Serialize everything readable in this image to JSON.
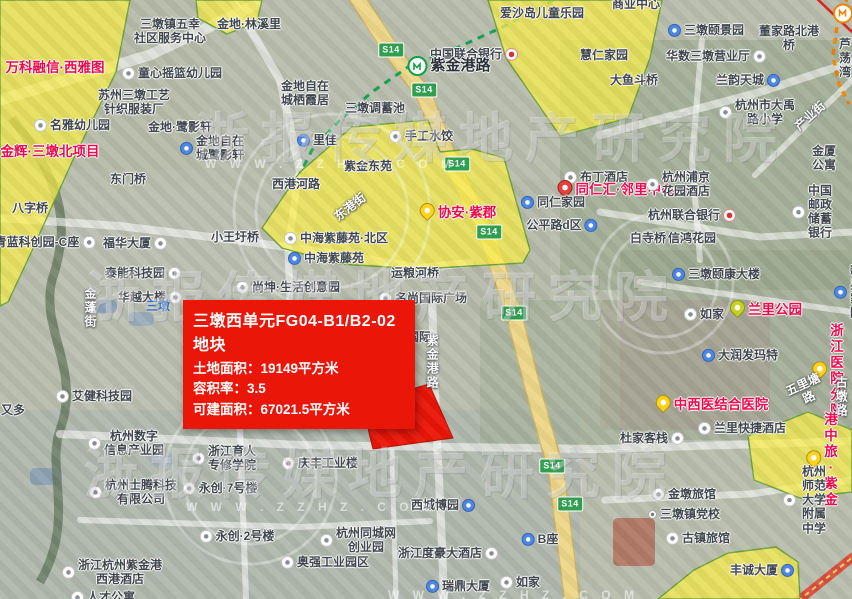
{
  "map": {
    "colors": {
      "parcel_yellow": "#faee46",
      "parcel_border": "#6fa23a",
      "parcel_red": "#ea1608",
      "metro_green": "#18a558",
      "metro_orange": "#f08300",
      "expressway_yellow": "#edd78a"
    },
    "callout": {
      "title": "三墩西单元FG04-B1/B2-02地块",
      "lines": [
        "土地面积：19149平方米",
        "容积率：3.5",
        "可建面积：67021.5平方米"
      ]
    },
    "watermark": {
      "brand": "浙报传媒地产研究院",
      "site": "W W W . Z Z H Z . C O M",
      "big_rows": [
        {
          "x": 195,
          "y": 94
        },
        {
          "x": 86,
          "y": 253
        },
        {
          "x": 84,
          "y": 430
        }
      ],
      "small_rows": [
        {
          "x": 205,
          "y": 157
        },
        {
          "x": 186,
          "y": 500
        },
        {
          "x": 388,
          "y": 588
        }
      ]
    },
    "s14": {
      "label": "S14",
      "positions": [
        [
          391,
          50
        ],
        [
          424,
          90
        ],
        [
          457,
          164
        ],
        [
          489,
          232
        ],
        [
          514,
          313
        ],
        [
          552,
          466
        ],
        [
          570,
          504
        ]
      ]
    },
    "parcels": {
      "yellow": [
        {
          "pts": "0,0 130,0 116,72 72,162 30,255 8,302 0,306"
        },
        {
          "pts": "196,0 262,0 257,22 227,34 198,18"
        },
        {
          "pts": "488,0 662,0 650,58 628,118 560,136 506,58"
        },
        {
          "pts": "300,172 352,127 428,120 440,152 472,149 504,158 530,250 523,263 420,269 340,264 282,248 262,228"
        },
        {
          "pts": "748,436 808,412 852,430 852,492 800,498 754,480"
        },
        {
          "pts": "658,599 694,570 728,553 776,547 798,562 800,599"
        }
      ],
      "red": {
        "pts": "362,404 429,384 453,438 373,449"
      },
      "tail": {
        "pts": "328,394 437,412 388,394"
      }
    },
    "labels": [
      {
        "t": "三墩镇五幸\n社区服务中心",
        "x": 170,
        "y": 31,
        "c": "poi"
      },
      {
        "t": "金地·林溪里",
        "x": 249,
        "y": 24,
        "c": "poi"
      },
      {
        "t": "童心摇篮幼儿园",
        "x": 172,
        "y": 73,
        "c": "poi",
        "ic": "w"
      },
      {
        "t": "苏州三墩工艺\n针织服装厂",
        "x": 134,
        "y": 102,
        "c": "poi"
      },
      {
        "t": "名雅幼儿园",
        "x": 72,
        "y": 125,
        "c": "poi",
        "ic": "w"
      },
      {
        "t": "金地·鹭影轩",
        "x": 180,
        "y": 127,
        "c": "poi"
      },
      {
        "t": "金地自在\n城鹭影轩",
        "x": 212,
        "y": 148,
        "c": "poi",
        "ic": "b"
      },
      {
        "t": "万科融信·西雅图",
        "x": 55,
        "y": 68,
        "c": "red"
      },
      {
        "t": "金辉·三墩北项目",
        "x": 50,
        "y": 152,
        "c": "red"
      },
      {
        "t": "东门桥",
        "x": 128,
        "y": 179,
        "c": "poi"
      },
      {
        "t": "西港河路",
        "x": 296,
        "y": 184,
        "c": "poi"
      },
      {
        "t": "八字桥",
        "x": 30,
        "y": 208,
        "c": "poi"
      },
      {
        "t": "青蓝科创园-C座",
        "x": 45,
        "y": 242,
        "c": "poi",
        "ic": "w",
        "s": "r"
      },
      {
        "t": "福华大厦",
        "x": 135,
        "y": 243,
        "c": "poi",
        "ic": "w",
        "s": "r"
      },
      {
        "t": "小王圩桥",
        "x": 235,
        "y": 237,
        "c": "poi"
      },
      {
        "t": "泰能科技园",
        "x": 143,
        "y": 273,
        "c": "poi",
        "ic": "w",
        "s": "r"
      },
      {
        "t": "华越大楼",
        "x": 150,
        "y": 297,
        "c": "poi",
        "ic": "w",
        "s": "r"
      },
      {
        "t": "三墩",
        "x": 158,
        "y": 306,
        "c": "blue"
      },
      {
        "t": "尚坤·生活创意园",
        "x": 288,
        "y": 287,
        "c": "poi",
        "ic": "w"
      },
      {
        "t": "金蓬街",
        "x": 90,
        "y": 308,
        "c": "roadw",
        "v": 1
      },
      {
        "t": "艾健科技园",
        "x": 94,
        "y": 396,
        "c": "poi",
        "ic": "w"
      },
      {
        "t": "又多",
        "x": 13,
        "y": 410,
        "c": "poi"
      },
      {
        "t": "爱沙岛儿童乐园",
        "x": 542,
        "y": 13,
        "c": "poi"
      },
      {
        "t": "中国联合银行",
        "x": 474,
        "y": 54,
        "c": "poi",
        "ic": "k",
        "s": "r"
      },
      {
        "t": "紫金港路",
        "x": 449,
        "y": 66,
        "c": "station",
        "ic": "mg"
      },
      {
        "t": "金地自在\n城栖霞居",
        "x": 305,
        "y": 93,
        "c": "poi"
      },
      {
        "t": "里佳",
        "x": 317,
        "y": 140,
        "c": "poi",
        "ic": "b"
      },
      {
        "t": "三墩调蓄池",
        "x": 375,
        "y": 108,
        "c": "poi"
      },
      {
        "t": "手工水饺",
        "x": 421,
        "y": 136,
        "c": "poi",
        "ic": "w"
      },
      {
        "t": "紫金东苑",
        "x": 368,
        "y": 166,
        "c": "poi"
      },
      {
        "t": "东港街",
        "x": 350,
        "y": 207,
        "c": "roadw",
        "r": -38
      },
      {
        "t": "中海紫藤苑·北区",
        "x": 336,
        "y": 238,
        "c": "poi",
        "ic": "w"
      },
      {
        "t": "中海紫藤苑",
        "x": 326,
        "y": 258,
        "c": "poi",
        "ic": "b"
      },
      {
        "t": "协安·紫郡",
        "x": 458,
        "y": 213,
        "c": "red2",
        "ic": "py"
      },
      {
        "t": "运粮河桥",
        "x": 415,
        "y": 273,
        "c": "poi"
      },
      {
        "t": "名尚国际广场",
        "x": 423,
        "y": 298,
        "c": "poi",
        "ic": "w"
      },
      {
        "t": "国际",
        "x": 419,
        "y": 337,
        "c": "poi"
      },
      {
        "t": "紫金港路",
        "x": 432,
        "y": 362,
        "c": "roadw",
        "v": 1
      },
      {
        "t": "商业中心",
        "x": 636,
        "y": 4,
        "c": "poi"
      },
      {
        "t": "三墩颐景园",
        "x": 706,
        "y": 30,
        "c": "poi",
        "ic": "b"
      },
      {
        "t": "董家路北港桥",
        "x": 789,
        "y": 38,
        "c": "poi"
      },
      {
        "t": "慧仁家园",
        "x": 604,
        "y": 55,
        "c": "poi"
      },
      {
        "t": "华数三墩营业厅",
        "x": 716,
        "y": 56,
        "c": "poi",
        "ic": "w",
        "s": "r"
      },
      {
        "t": "芦荡湾",
        "x": 845,
        "y": 58,
        "c": "poi"
      },
      {
        "t": "大鱼斗桥",
        "x": 634,
        "y": 80,
        "c": "poi"
      },
      {
        "t": "兰韵天城",
        "x": 748,
        "y": 80,
        "c": "poi",
        "ic": "b",
        "s": "r"
      },
      {
        "t": "杭州市大禹\n路小学",
        "x": 757,
        "y": 112,
        "c": "poi",
        "ic": "w"
      },
      {
        "t": "产业街",
        "x": 810,
        "y": 116,
        "c": "roadw",
        "r": -42
      },
      {
        "t": "金厦公寓",
        "x": 824,
        "y": 158,
        "c": "poi"
      },
      {
        "t": "中国邮政\n储蓄银行",
        "x": 812,
        "y": 212,
        "c": "poi",
        "ic": "w"
      },
      {
        "t": "墩祥街",
        "x": 852,
        "y": 13,
        "c": "station",
        "ic": "mo"
      },
      {
        "t": "布丁酒店",
        "x": 596,
        "y": 177,
        "c": "poi",
        "ic": "w"
      },
      {
        "t": "同仁汇·邻里中心",
        "x": 616,
        "y": 190,
        "c": "red2",
        "ic": "pr"
      },
      {
        "t": "同仁家园",
        "x": 553,
        "y": 202,
        "c": "poi",
        "ic": "b"
      },
      {
        "t": "杭州浦京\n花园酒店",
        "x": 678,
        "y": 184,
        "c": "poi",
        "ic": "w"
      },
      {
        "t": "杭州联合银行",
        "x": 692,
        "y": 215,
        "c": "poi",
        "ic": "k",
        "s": "r"
      },
      {
        "t": "公平路d区",
        "x": 562,
        "y": 225,
        "c": "poi",
        "ic": "b",
        "s": "r"
      },
      {
        "t": "白寺桥",
        "x": 648,
        "y": 238,
        "c": "poi"
      },
      {
        "t": "信鸿花园",
        "x": 692,
        "y": 238,
        "c": "poi"
      },
      {
        "t": "三墩颐康大楼",
        "x": 716,
        "y": 274,
        "c": "poi",
        "ic": "b"
      },
      {
        "t": "新星家园",
        "x": 848,
        "y": 292,
        "c": "poi",
        "ic": "b"
      },
      {
        "t": "兰里公园",
        "x": 766,
        "y": 310,
        "c": "red2",
        "ic": "pg"
      },
      {
        "t": "如家",
        "x": 704,
        "y": 314,
        "c": "poi",
        "ic": "w"
      },
      {
        "t": "大润发玛特",
        "x": 740,
        "y": 355,
        "c": "poi",
        "ic": "b"
      },
      {
        "t": "浙江医院分院",
        "x": 828,
        "y": 371,
        "c": "red2",
        "ic": "py"
      },
      {
        "t": "中西医结合医院",
        "x": 712,
        "y": 405,
        "c": "red2",
        "ic": "py"
      },
      {
        "t": "五里塘路",
        "x": 806,
        "y": 391,
        "c": "roadw",
        "r": -25
      },
      {
        "t": "古墩路",
        "x": 841,
        "y": 397,
        "c": "roadw",
        "v": 1
      },
      {
        "t": "兰里快捷酒店",
        "x": 742,
        "y": 428,
        "c": "poi",
        "ic": "w"
      },
      {
        "t": "杜家客栈",
        "x": 652,
        "y": 438,
        "c": "poi",
        "ic": "w",
        "s": "r"
      },
      {
        "t": "港中旅·紫金",
        "x": 822,
        "y": 460,
        "c": "red2",
        "ic": "py"
      },
      {
        "t": "金墩旅馆",
        "x": 684,
        "y": 494,
        "c": "poi",
        "ic": "w"
      },
      {
        "t": "杭州师范大学\n附属中学",
        "x": 806,
        "y": 500,
        "c": "poi",
        "ic": "w"
      },
      {
        "t": "三墩镇党校",
        "x": 684,
        "y": 514,
        "c": "poi",
        "ic": "d"
      },
      {
        "t": "古镇旅馆",
        "x": 698,
        "y": 538,
        "c": "poi",
        "ic": "w"
      },
      {
        "t": "丰诚大厦",
        "x": 762,
        "y": 570,
        "c": "poi",
        "ic": "b",
        "s": "r"
      },
      {
        "t": "杭州奥能电源\n设备公司",
        "x": 283,
        "y": 396,
        "c": "poi",
        "ic": "w"
      },
      {
        "t": "杭州数字\n信息产业园",
        "x": 126,
        "y": 443,
        "c": "poi",
        "ic": "w"
      },
      {
        "t": "浙江育人\n专修学院",
        "x": 224,
        "y": 458,
        "c": "poi",
        "ic": "w"
      },
      {
        "t": "庆丰工业楼",
        "x": 320,
        "y": 463,
        "c": "poi",
        "ic": "w"
      },
      {
        "t": "杭州士腾科技\n有限公司",
        "x": 133,
        "y": 492,
        "c": "poi",
        "ic": "w"
      },
      {
        "t": "永创·7号楼",
        "x": 220,
        "y": 488,
        "c": "poi",
        "ic": "w"
      },
      {
        "t": "永创·2号楼",
        "x": 237,
        "y": 536,
        "c": "poi",
        "ic": "w"
      },
      {
        "t": "浙江杭州紫金港\n西港酒店",
        "x": 112,
        "y": 572,
        "c": "poi",
        "ic": "w"
      },
      {
        "t": "人才公寓",
        "x": 103,
        "y": 597,
        "c": "poi",
        "ic": "w"
      },
      {
        "t": "杭州同城网\n创业园",
        "x": 358,
        "y": 540,
        "c": "poi",
        "ic": "w"
      },
      {
        "t": "奥强工业园区",
        "x": 325,
        "y": 562,
        "c": "poi",
        "ic": "w"
      },
      {
        "t": "西城博园",
        "x": 443,
        "y": 505,
        "c": "poi",
        "ic": "b",
        "s": "r"
      },
      {
        "t": "浙江度豪大酒店",
        "x": 448,
        "y": 553,
        "c": "poi",
        "ic": "w",
        "s": "r"
      },
      {
        "t": "B座",
        "x": 540,
        "y": 539,
        "c": "poi",
        "ic": "b"
      },
      {
        "t": "瑞鼎大厦",
        "x": 458,
        "y": 586,
        "c": "poi",
        "ic": "b"
      },
      {
        "t": "如家",
        "x": 520,
        "y": 582,
        "c": "poi",
        "ic": "w"
      }
    ]
  }
}
